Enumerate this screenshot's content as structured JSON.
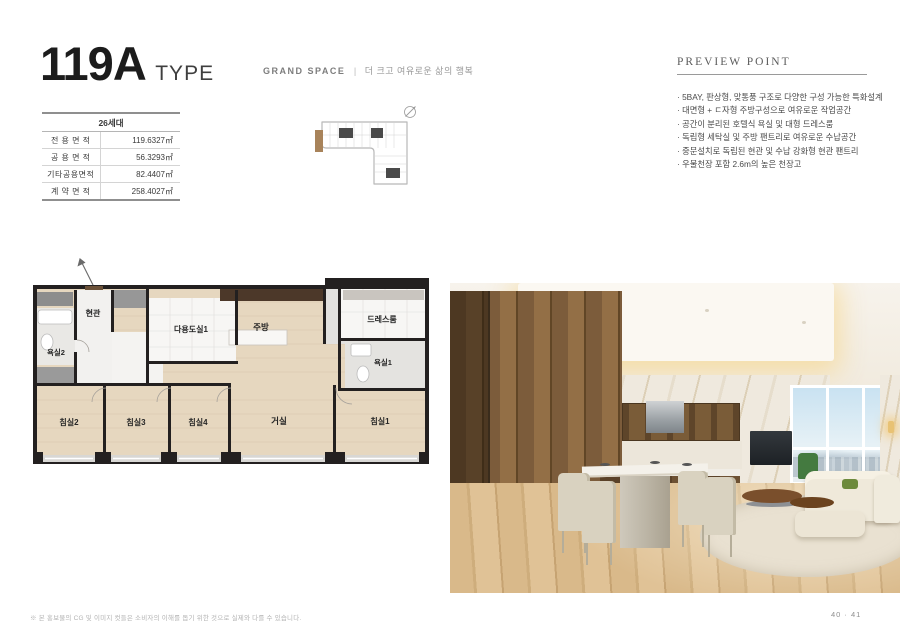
{
  "page": {
    "title": "119A",
    "title_suffix": "TYPE",
    "section_label": "GRAND SPACE",
    "section_divider": "|",
    "section_tagline": "더 크고 여유로운 삶의 행복",
    "footnote": "※ 본 홍보물의 CG 및 이미지 컷들은 소비자의 이해를 돕기 위한 것으로 실제와 다를 수 있습니다.",
    "page_number": "40 · 41"
  },
  "spec_table": {
    "header": "26세대",
    "rows": [
      {
        "label": "전 용 면 적",
        "value": "119.6327㎡"
      },
      {
        "label": "공 용 면 적",
        "value": "56.3293㎡"
      },
      {
        "label": "기타공용면적",
        "value": "82.4407㎡"
      },
      {
        "label": "계 약 면 적",
        "value": "258.4027㎡"
      }
    ]
  },
  "preview_point": {
    "heading": "PREVIEW POINT",
    "items": [
      "· 5BAY, 판상형, 맞통풍 구조로 다양한 구성 가능한 특화설계",
      "· 대면형 + ㄷ자형 주방구성으로 여유로운 작업공간",
      "· 공간이 분리된 호텔식 욕실 및 대형 드레스룸",
      "· 독립형 세탁실 및 주방 팬트리로 여유로운 수납공간",
      "· 중문설치로 독립된 현관 및 수납 강화형 현관 팬트리",
      "· 우물천장 포함 2.6m의 높은 천장고"
    ]
  },
  "floor_plan": {
    "rooms": {
      "entrance": "현관",
      "bath2": "욕실2",
      "utility1": "다용도실1",
      "kitchen": "주방",
      "dressroom": "드레스룸",
      "bath1": "욕실1",
      "bedroom2": "침실2",
      "bedroom3": "침실3",
      "bedroom4": "침실4",
      "living": "거실",
      "bedroom1": "침실1"
    }
  },
  "colors": {
    "wall": "#232020",
    "wood_floor": "#e6d7bf",
    "unit_highlight": "#a8835a",
    "accent_text": "#1c1c1c",
    "muted_text": "#8c8c8c"
  }
}
